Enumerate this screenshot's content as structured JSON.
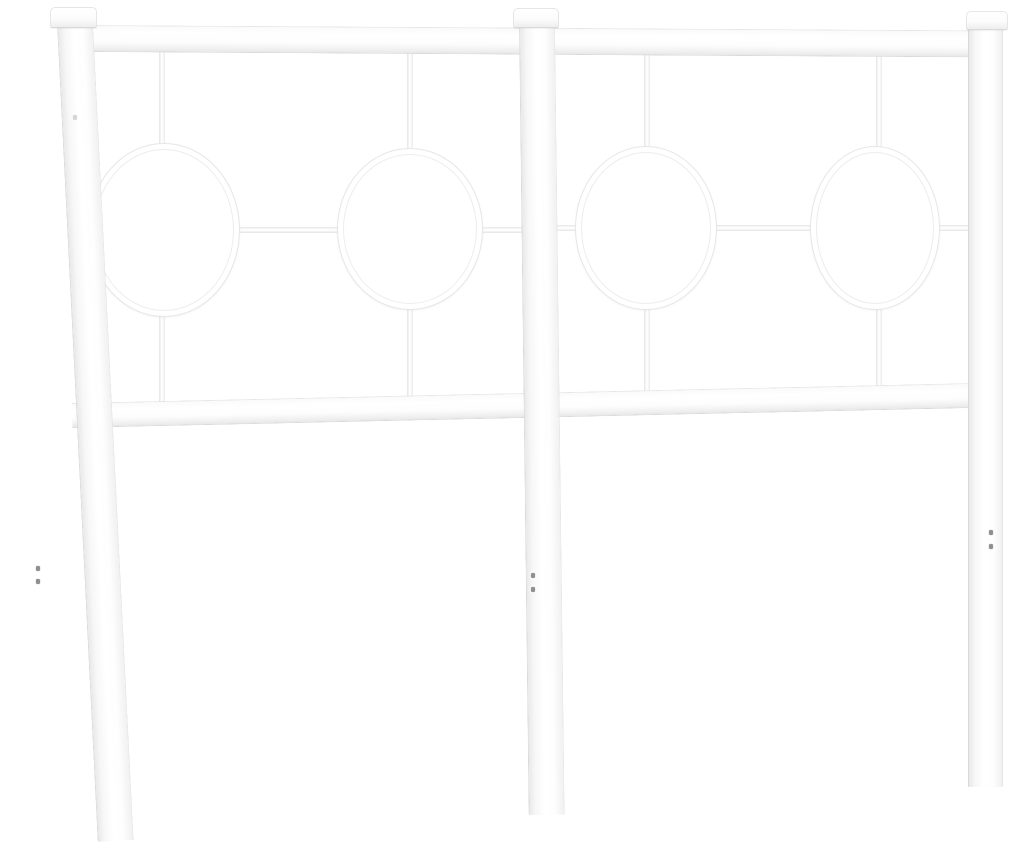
{
  "meta": {
    "description": "Product photo: white metal bed headboard with three capped posts, a top rail, a lower rail, and four circle ornaments joined by thin spindles, on a plain white background",
    "object": "white-metal-headboard",
    "text_content": "none"
  },
  "colors": {
    "background": "#ffffff",
    "metal_white": "#ffffff",
    "edge_shade": "#e6e6e6",
    "deep_shade": "#d9d9d9",
    "screw_gray": "#8f8f8f"
  },
  "counts": {
    "posts": 3,
    "finial_caps": 3,
    "rails": 2,
    "circle_ornaments": 4,
    "spindles": 8,
    "crossbars": 2,
    "screw_holes": 7
  },
  "geometry": {
    "canvas": {
      "w": 1013,
      "h": 849
    },
    "rails": {
      "top": {
        "x": 91,
        "y": 25,
        "w": 882,
        "h": 27,
        "rot": 0.35
      },
      "bottom": {
        "x": 72,
        "y": 403,
        "w": 900,
        "h": 25,
        "rot": -1.27
      }
    },
    "crossbars": {
      "left": {
        "x": 78,
        "y": 227,
        "w": 444,
        "h": 6
      },
      "right": {
        "x": 552,
        "y": 225,
        "w": 420,
        "h": 6
      }
    },
    "spindles": {
      "c1top": {
        "x": 159,
        "y": 48,
        "w": 6,
        "h": 100
      },
      "c2top": {
        "x": 407,
        "y": 48,
        "w": 6,
        "h": 103
      },
      "c3top": {
        "x": 644,
        "y": 50,
        "w": 6,
        "h": 100
      },
      "c4top": {
        "x": 876,
        "y": 50,
        "w": 6,
        "h": 100
      },
      "c1bot": {
        "x": 159,
        "y": 310,
        "w": 6,
        "h": 95
      },
      "c2bot": {
        "x": 407,
        "y": 308,
        "w": 6,
        "h": 92
      },
      "c3bot": {
        "x": 644,
        "y": 308,
        "w": 6,
        "h": 86
      },
      "c4bot": {
        "x": 876,
        "y": 308,
        "w": 6,
        "h": 80
      }
    },
    "rings": {
      "c1": {
        "x": 88,
        "y": 143,
        "w": 152,
        "h": 174
      },
      "c2": {
        "x": 337,
        "y": 148,
        "w": 146,
        "h": 162
      },
      "c3": {
        "x": 575,
        "y": 146,
        "w": 142,
        "h": 164
      },
      "c4": {
        "x": 810,
        "y": 146,
        "w": 130,
        "h": 164
      }
    },
    "posts": {
      "left": {
        "x": 57,
        "y": 24,
        "w": 36,
        "h": 818,
        "rot": -2.85
      },
      "center": {
        "x": 519,
        "y": 24,
        "w": 36,
        "h": 791,
        "rot": -0.7
      },
      "right": {
        "x": 968,
        "y": 26,
        "w": 35,
        "h": 761,
        "rot": 0
      }
    },
    "caps": {
      "left": {
        "x": 50,
        "y": 7,
        "w": 47,
        "h": 21
      },
      "center": {
        "x": 513,
        "y": 8,
        "w": 46,
        "h": 20
      },
      "right": {
        "x": 966,
        "y": 11,
        "w": 42,
        "h": 19
      }
    },
    "screw_holes": [
      {
        "x": 36,
        "y": 566
      },
      {
        "x": 36,
        "y": 579
      },
      {
        "x": 531,
        "y": 573
      },
      {
        "x": 531,
        "y": 587
      },
      {
        "x": 989,
        "y": 530
      },
      {
        "x": 989,
        "y": 544
      },
      {
        "x": 73,
        "y": 115,
        "faint": true
      }
    ]
  }
}
